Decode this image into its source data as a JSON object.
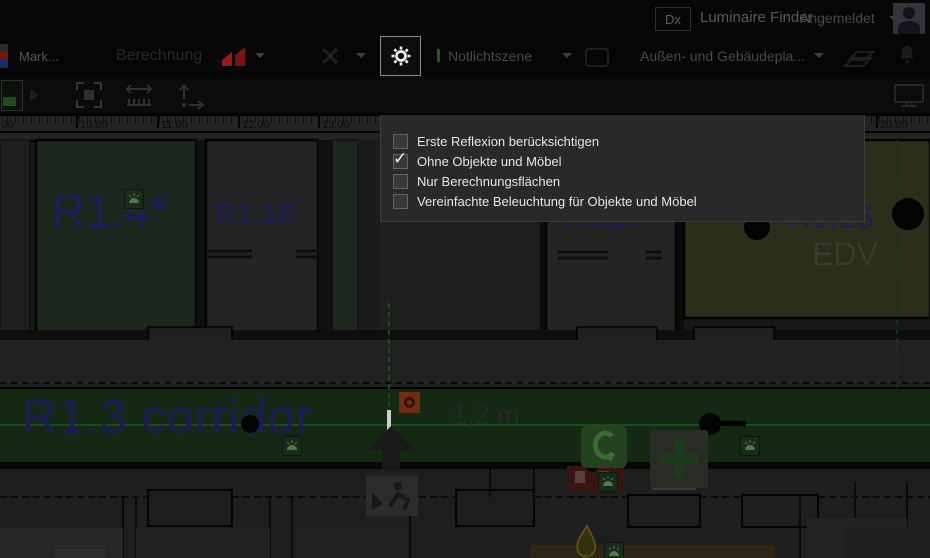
{
  "top_bar": {
    "logo_text": "Dx",
    "app_name": "Luminaire Finder",
    "account_label": "Angemeldet"
  },
  "toolbar": {
    "mark_label": "Mark...",
    "calculation_label": "Berechnung",
    "emergency_scene_label": "Notlichtszene",
    "planning_dropdown_label": "Außen- und Gebäudepla..."
  },
  "scene_panel": {
    "tabs": [
      {
        "label": "Standard Lichtszenen",
        "indicator_color": "#f2f2f2",
        "active": true
      },
      {
        "label": "Notlichtszene",
        "indicator_color": "#1d4a26",
        "active": false
      },
      {
        "label": "Störlichtszene",
        "indicator_color": "#e0da20",
        "active": false
      }
    ],
    "options": [
      {
        "label": "Erste Reflexion berücksichtigen",
        "checked": false
      },
      {
        "label": "Ohne Objekte und Möbel",
        "checked": true
      },
      {
        "label": "Nur Berechnungsflächen",
        "checked": false
      },
      {
        "label": "Vereinfachte Beleuchtung für Objekte und Möbel",
        "checked": false
      }
    ],
    "check_glyph": "✓"
  },
  "ruler": {
    "unit_labels": [
      ",00",
      "10,00",
      "11,00",
      "12,00",
      "13,00",
      "20,00"
    ]
  },
  "floorplan": {
    "room_labels": {
      "r14": "R1.4*",
      "r118": "R1.18",
      "r117": "R1.17",
      "r116": "R1.16",
      "r116_sub": "EDV",
      "corridor": "R1.3 corridor"
    },
    "dimension_label": "1,2 m"
  },
  "colors": {
    "emergency_green": "#1e5c28",
    "corridor_green": "#142814",
    "room_green": "#1c261c",
    "room_olive": "#2d2d1b",
    "label_blue": "#1d1d60"
  }
}
